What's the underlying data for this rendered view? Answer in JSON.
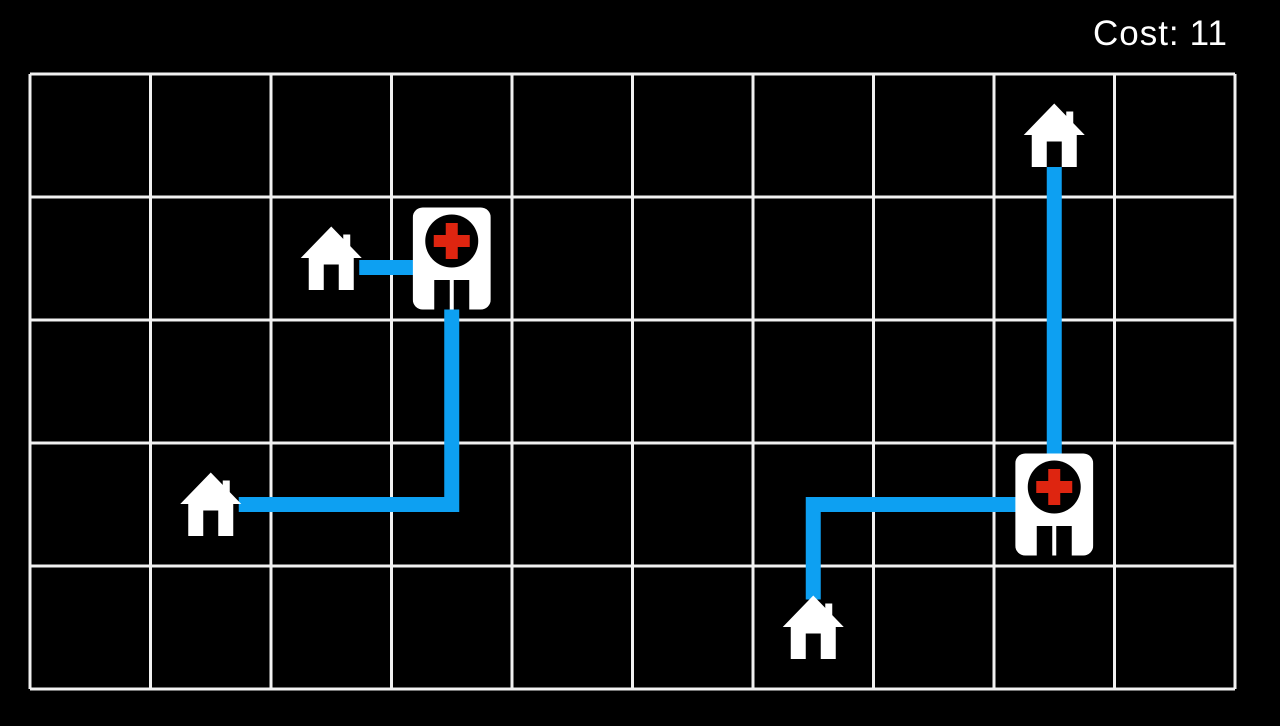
{
  "hud": {
    "cost_label": "Cost:",
    "cost_value": "11"
  },
  "colors": {
    "background": "#000000",
    "grid_line": "#f1f1f1",
    "path_blue": "#0da0f2",
    "icon_white": "#ffffff",
    "cross_red": "#de2510",
    "hud_text": "#ffffff"
  },
  "board": {
    "cols": 10,
    "rows": 5,
    "left": 30,
    "top": 74,
    "cell_w": 120.5,
    "cell_h": 123,
    "line_width": 3
  },
  "entities": {
    "houses": [
      {
        "id": "house-1",
        "col": 2,
        "row": 1
      },
      {
        "id": "house-2",
        "col": 1,
        "row": 3
      },
      {
        "id": "house-3",
        "col": 6,
        "row": 4
      },
      {
        "id": "house-4",
        "col": 8,
        "row": 0
      }
    ],
    "hospitals": [
      {
        "id": "hospital-1",
        "col": 3,
        "row": 1
      },
      {
        "id": "hospital-2",
        "col": 8,
        "row": 3
      }
    ]
  },
  "paths": [
    {
      "from": "house-1",
      "to": "hospital-1",
      "route": [
        [
          2,
          1
        ],
        [
          3,
          1
        ]
      ],
      "dy": 9
    },
    {
      "from": "house-2",
      "to": "hospital-1",
      "route": [
        [
          1,
          3
        ],
        [
          3,
          3
        ],
        [
          3,
          1
        ]
      ]
    },
    {
      "from": "house-4",
      "to": "hospital-2",
      "route": [
        [
          8,
          0
        ],
        [
          8,
          3
        ]
      ]
    },
    {
      "from": "house-3",
      "to": "hospital-2",
      "route": [
        [
          6,
          4
        ],
        [
          6,
          3
        ],
        [
          8,
          3
        ]
      ]
    }
  ]
}
